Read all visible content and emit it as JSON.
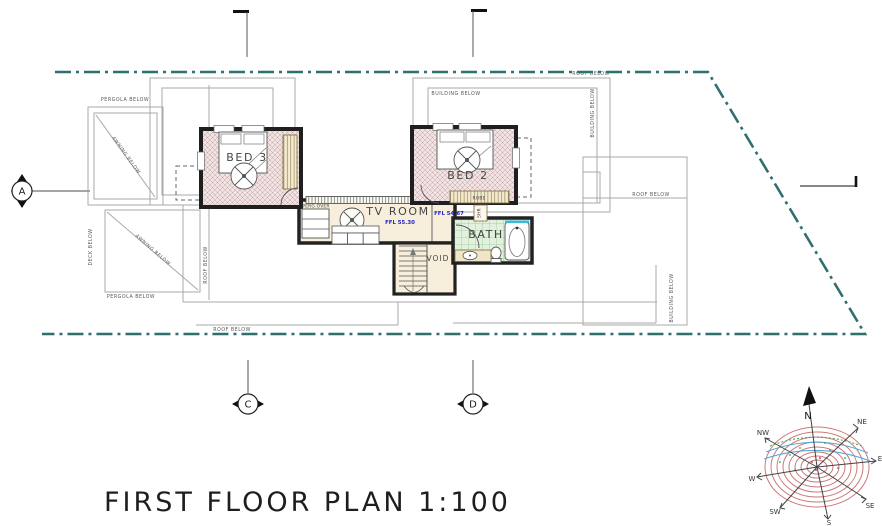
{
  "drawing": {
    "title": "FIRST FLOOR PLAN 1:100"
  },
  "rooms": {
    "bed3": "BED 3",
    "bed2": "BED 2",
    "tv_room": "TV ROOM",
    "bath": "BATH",
    "void": "VOID",
    "robe": "ROBE",
    "shr": "SHR",
    "perg_over": "PERG OVER",
    "ffl_tv": "FFL 55.30",
    "ffl_hall": "FFL 54.67"
  },
  "annotations": {
    "pergola_below_top": "PERGOLA BELOW",
    "pergola_below_bottom": "PERGOLA BELOW",
    "awning_below_upper": "AWNING BELOW",
    "awning_below_lower": "AWNING BELOW",
    "deck_below": "DECK BELOW",
    "roof_below_left": "ROOF BELOW",
    "roof_below_bottom": "ROOF BELOW",
    "roof_below_top": "ROOF BELOW",
    "roof_below_right": "ROOF BELOW",
    "building_below_top": "BUILDING BELOW",
    "building_below_east1": "BUILDING BELOW",
    "building_below_east2": "BUILDING BELOW"
  },
  "grid_markers": {
    "a": "A",
    "c": "C",
    "d": "D"
  },
  "compass": {
    "directions": [
      "N",
      "NE",
      "E",
      "SE",
      "S",
      "SW",
      "W",
      "NW"
    ]
  },
  "colors": {
    "boundary": "#2f6f6d",
    "wall": "#1f1f1f",
    "floor_bedroom": "#f0e3e3",
    "floor_living": "#f7eedb",
    "floor_bath": "#e2f0de",
    "ffl_text": "#2323c8",
    "compass_rings": "#cc7878",
    "outline_gray": "#a8a8a8"
  }
}
